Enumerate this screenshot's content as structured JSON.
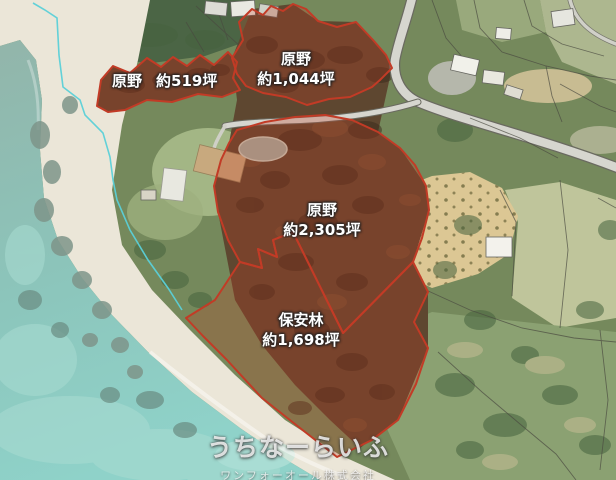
{
  "parcels": [
    {
      "id": "519",
      "category": "原野",
      "area": "約519坪"
    },
    {
      "id": "1044",
      "category": "原野",
      "area": "約1,044坪"
    },
    {
      "id": "2305",
      "category": "原野",
      "area": "約2,305坪"
    },
    {
      "id": "1698",
      "category": "保安林",
      "area": "約1,698坪"
    }
  ],
  "watermark": {
    "title": "うちなーらいふ",
    "subtitle": "ワンフォーオール株式会社"
  },
  "colors": {
    "boundary_red": "#c23b26",
    "parcel_fill": "rgba(194,58,35,0.27)",
    "coastline_cyan": "#5bd0d8",
    "ocean": "#8fc7bd",
    "sand": "#ebe6d8",
    "forest_brown": "#5e4730",
    "vegetation_green": "#75895c",
    "road_gray": "#d6d6cf",
    "field_tan": "#dcc794",
    "label_text": "#ffffff"
  }
}
